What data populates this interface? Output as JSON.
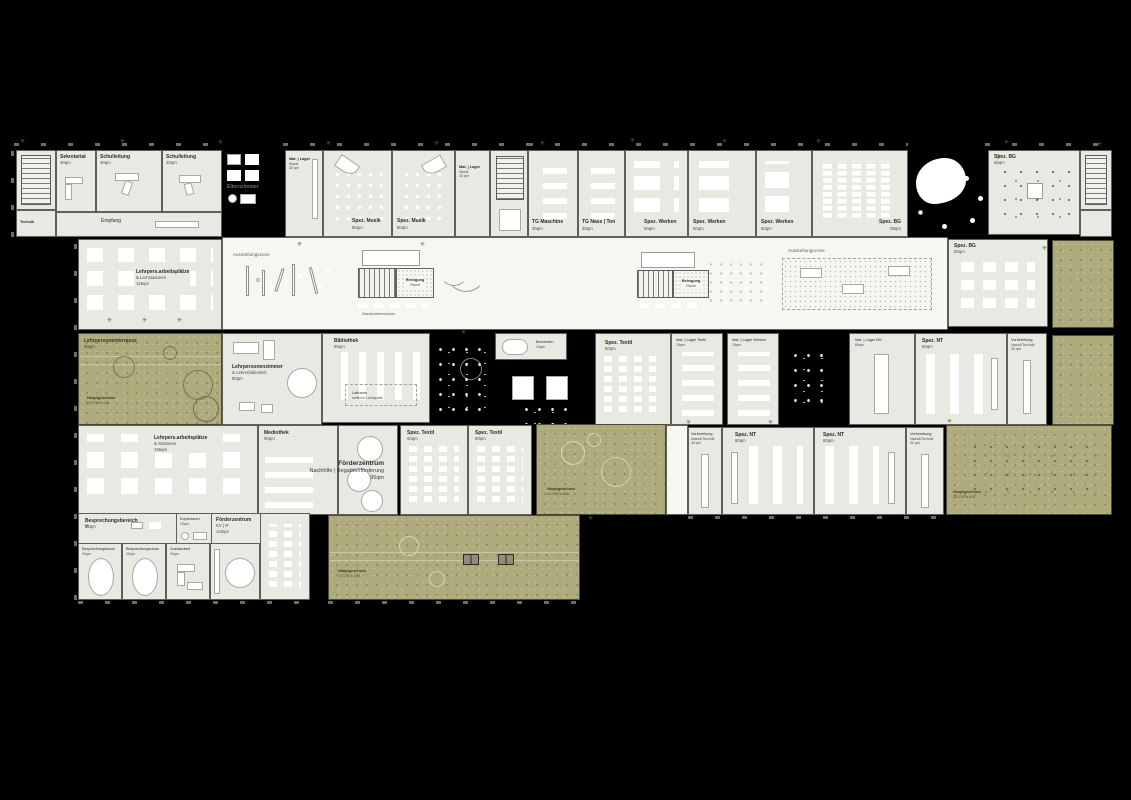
{
  "colors": {
    "background": "#000000",
    "room_fill": "#e9e9e3",
    "hall_fill": "#f6f6f2",
    "terrace_green": "#adaa7c",
    "plant_green": "#3c7d22"
  },
  "icons": {
    "plant": "✳"
  },
  "rooms": {
    "sekretariat": {
      "name": "Sekretariat",
      "area": "40qm"
    },
    "schulleitung40": {
      "name": "Schulleitung",
      "area": "40qm"
    },
    "schulleitung20": {
      "name": "Schulleitung",
      "area": "20qm"
    },
    "empfang": {
      "name": "Empfang"
    },
    "technik": {
      "name": "Technik"
    },
    "elternzimmer": {
      "name": "Elternzimmer"
    },
    "mat_lager_musik": {
      "name": "Mat. | Lager",
      "sub": "Musik",
      "area": "30 qm"
    },
    "spez_musik": {
      "name": "Spez. Musik",
      "area": "80qm"
    },
    "tg_maschine": {
      "name": "TG Maschine",
      "area": "30qm"
    },
    "tg_nass_ton": {
      "name": "TG Nass | Ton",
      "area": "30qm"
    },
    "spez_werken": {
      "name": "Spez. Werken",
      "area": "60qm"
    },
    "spez_bg80": {
      "name": "Spez. BG",
      "area": "80qm"
    },
    "spez_bg65": {
      "name": "Spez. BG",
      "area": "65qm"
    },
    "spez_bg60": {
      "name": "Spez. BG",
      "area": "60qm"
    },
    "lehrpers125": {
      "name": "Lehrpers.arbeitsplätze",
      "sub": "& Lernstationen",
      "area": "125qm"
    },
    "ausstellungszone": {
      "name": "Ausstellungszone"
    },
    "reinigung": {
      "name": "Reinigung",
      "sub": "Raum"
    },
    "garderoben": {
      "name": "Garderobennischen"
    },
    "lehrterrasse": {
      "name": "Lehrpersonenterrasse",
      "area": "90qm"
    },
    "hauptgeschoss": {
      "name": "Hauptgeschoss",
      "sub": "24.178 m ü.M."
    },
    "lehrperszimmer": {
      "name": "Lehrpersonenzimmer",
      "sub": "& Lehrerbibliothek",
      "area": "80qm"
    },
    "bibliothek": {
      "name": "Bibliothek",
      "area": "95qm"
    },
    "luftraum": {
      "name": "Luftraum",
      "sub": "seitliche Lichtquelle"
    },
    "brennofen": {
      "name": "Brennofen",
      "area": "15qm"
    },
    "spez_textil": {
      "name": "Spez. Textil",
      "area": "60qm"
    },
    "mat_lager_textil": {
      "name": "Mat. | Lager Textil",
      "area": "15qm"
    },
    "mat_lager_werken": {
      "name": "Mat. | Lager Werken",
      "area": "15qm"
    },
    "mat_lager_bg": {
      "name": "Mat. | Lager BG",
      "area": "60qm"
    },
    "spez_nt60": {
      "name": "Spez. NT",
      "area": "60qm"
    },
    "vorb_nt30": {
      "name": "Vorbereitung",
      "sub": "Natur&Technik",
      "area": "30 qm"
    },
    "vorb_nt40": {
      "name": "Vorbereitung",
      "sub": "Natur&Technik",
      "area": "40 qm"
    },
    "spez_nt80": {
      "name": "Spez. NT",
      "area": "80qm"
    },
    "lehrpers195": {
      "name": "Lehrpers.arbeitsplätze",
      "sub": "& Stationen",
      "area": "195qm"
    },
    "mediothek": {
      "name": "Mediothek",
      "area": "90qm"
    },
    "foerderzentrum95": {
      "name": "Förderzentrum",
      "sub": "Nachhilfe | Begabtenförderung",
      "area": "95qm"
    },
    "besprbereich": {
      "name": "Besprechungsbereich",
      "area": "65qm"
    },
    "kopierraum": {
      "name": "Kopierraum",
      "area": "10qm"
    },
    "foerderkv": {
      "name": "Förderzentrum",
      "sub": "KV | IF",
      "area": "140qm"
    },
    "besprraum": {
      "name": "Besprechungsraum",
      "area": "20qm"
    },
    "sozialarbeit": {
      "name": "Sozialarbeit",
      "area": "20qm"
    }
  }
}
